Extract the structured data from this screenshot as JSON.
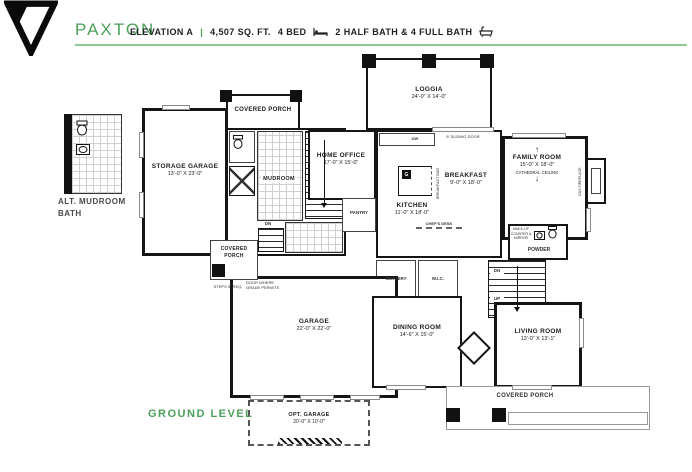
{
  "header": {
    "brand": "PAXTON",
    "elevation": "ELEVATION A",
    "separator": "|",
    "sqft": "4,507 SQ. FT.",
    "beds": "4 BED",
    "baths": "2 HALF BATH & 4 FULL BATH"
  },
  "colors": {
    "brand_green": "#4ba05b",
    "rule_green": "#8fc99a",
    "wall_black": "#151515"
  },
  "level_label": "GROUND LEVEL",
  "alt_plan": {
    "line1": "ALT. MUDROOM",
    "line2": "BATH"
  },
  "rooms": {
    "loggia": {
      "name": "LOGGIA",
      "dims": "24'-0\" X 14'-0\""
    },
    "covered_porch_top": {
      "name": "COVERED PORCH"
    },
    "storage_garage": {
      "name": "STORAGE GARAGE",
      "dims": "13'-0\" X 23'-0\""
    },
    "mudroom": {
      "name": "MUDROOM"
    },
    "home_office": {
      "name": "HOME OFFICE",
      "dims": "17'-0\" X 15'-0\""
    },
    "kitchen": {
      "name": "KITCHEN",
      "dims": "11'-0\" X 18'-0\""
    },
    "breakfast": {
      "name": "BREAKFAST",
      "dims": "9'-0\" X 18'-0\""
    },
    "family_room": {
      "name": "FAMILY ROOM",
      "dims": "15'-0\" X 18'-0\"",
      "note": "CATHEDRAL CEILING"
    },
    "pantry": {
      "name": "PANTRY"
    },
    "servery": {
      "name": "SERVERY"
    },
    "wic": {
      "name": "W.I.C."
    },
    "powder": {
      "name": "POWDER"
    },
    "garage": {
      "name": "GARAGE",
      "dims": "22'-0\" X 22'-0\""
    },
    "dining_room": {
      "name": "DINING ROOM",
      "dims": "14'-6\" X 15'-0\""
    },
    "living_room": {
      "name": "LIVING ROOM",
      "dims": "13'-0\" X 13'-1\""
    },
    "covered_porch_left": {
      "name_line1": "COVERED",
      "name_line2": "PORCH"
    },
    "covered_porch_bottom": {
      "name": "COVERED PORCH"
    },
    "opt_garage": {
      "name": "OPT. GARAGE",
      "dims": "20'-0\" X 10'-0\""
    }
  },
  "annotations": {
    "sliding_door": "8' SLIDING DOOR",
    "dw": "DW",
    "chefs_desk": "CHEF'S DESK",
    "breakfast_bar": "BREAKFAST BAR",
    "gas_fireplace": "GAS FIREPLACE",
    "makeup_counter": "MAKE-UP COUNTER & MIRROR",
    "door_grade_1": "DOOR WHERE",
    "door_grade_2": "GRADE PERMITS",
    "steps_req": "STEPS IF REQ.",
    "dn": "DN",
    "up": "UP"
  },
  "icons": {
    "arrow_up": "↑",
    "arrow_down": "↓"
  }
}
